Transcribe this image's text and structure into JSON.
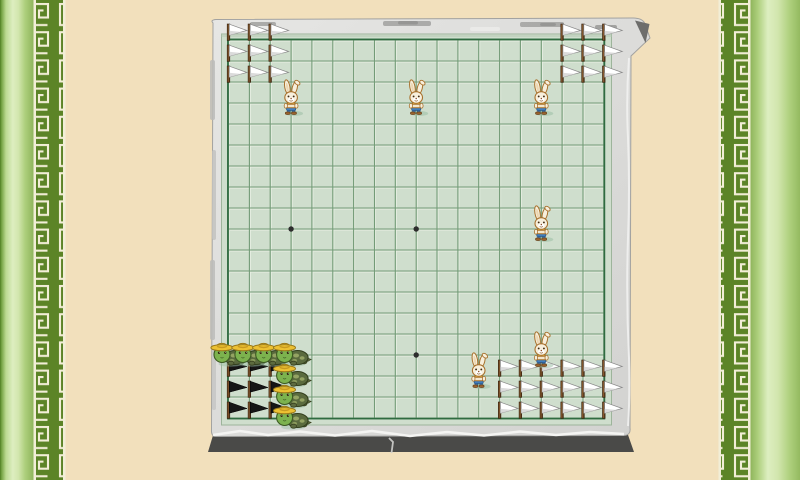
{
  "colors": {
    "background": "#f2e0bc",
    "side_gradient": [
      "#4e7d22",
      "#77a546",
      "#bcda92",
      "#ddeec0",
      "#d2e6ae",
      "#adcf7c",
      "#8fb55c"
    ],
    "meander_background": "#5c8427",
    "meander_pattern": "#f2eed7",
    "frame_light": "#dcdcda",
    "frame_mid": "#d2d2d0",
    "frame_dark_side": "#4a4a48",
    "board_background": "#cfdecd",
    "grid_line": "#6f9873",
    "grid_highlight": "#edf3e8",
    "grid_border": "#2f6b40",
    "star_point": "#2d2d2d",
    "white_flag": "#ffffff",
    "white_flag_shade": "#d5d5d5",
    "black_flag": "#161616",
    "flag_pole": "#5b3a1c",
    "flag_pole_dark": "#3a2410",
    "rabbit_body": "#f7efdc",
    "rabbit_outline": "#a8702c",
    "rabbit_pants": "#3f7dbd",
    "rabbit_shoes": "#9a6430",
    "turtle_skin": "#7cb24e",
    "turtle_skin_outline": "#3c5a22",
    "turtle_shell": "#5a6a3e",
    "turtle_shell_spot": "#94a363",
    "turtle_hat": "#ecc133",
    "turtle_hat_crown": "#f2ce49",
    "shadow": "#9dbfa6"
  },
  "board": {
    "type": "go-board",
    "lines": 19,
    "origin": [
      228.5,
      40
    ],
    "step": [
      20.85,
      21.0
    ],
    "star_points": [
      [
        3,
        3
      ],
      [
        9,
        3
      ],
      [
        15,
        3
      ],
      [
        3,
        9
      ],
      [
        9,
        9
      ],
      [
        15,
        9
      ],
      [
        3,
        15
      ],
      [
        9,
        15
      ],
      [
        15,
        15
      ]
    ]
  },
  "pieces": {
    "rabbits": {
      "name": "rabbit",
      "positions": [
        [
          3,
          3
        ],
        [
          9,
          3
        ],
        [
          15,
          3
        ],
        [
          15,
          9
        ],
        [
          15,
          15
        ],
        [
          12,
          16
        ]
      ]
    },
    "turtles": {
      "name": "turtle",
      "positions": [
        [
          0,
          15
        ],
        [
          1,
          15
        ],
        [
          2,
          15
        ],
        [
          3,
          15
        ],
        [
          3,
          16
        ],
        [
          3,
          17
        ],
        [
          3,
          18
        ]
      ]
    },
    "white_flags": {
      "name": "white-territory-flag",
      "positions": [
        [
          0,
          0
        ],
        [
          1,
          0
        ],
        [
          2,
          0
        ],
        [
          0,
          1
        ],
        [
          1,
          1
        ],
        [
          2,
          1
        ],
        [
          0,
          2
        ],
        [
          1,
          2
        ],
        [
          2,
          2
        ],
        [
          16,
          0
        ],
        [
          17,
          0
        ],
        [
          18,
          0
        ],
        [
          16,
          1
        ],
        [
          17,
          1
        ],
        [
          18,
          1
        ],
        [
          16,
          2
        ],
        [
          17,
          2
        ],
        [
          18,
          2
        ],
        [
          13,
          16
        ],
        [
          14,
          16
        ],
        [
          15,
          16
        ],
        [
          16,
          16
        ],
        [
          17,
          16
        ],
        [
          18,
          16
        ],
        [
          13,
          17
        ],
        [
          14,
          17
        ],
        [
          15,
          17
        ],
        [
          16,
          17
        ],
        [
          17,
          17
        ],
        [
          18,
          17
        ],
        [
          13,
          18
        ],
        [
          14,
          18
        ],
        [
          15,
          18
        ],
        [
          16,
          18
        ],
        [
          17,
          18
        ],
        [
          18,
          18
        ]
      ]
    },
    "black_flags": {
      "name": "black-territory-flag",
      "positions": [
        [
          0,
          16
        ],
        [
          1,
          16
        ],
        [
          2,
          16
        ],
        [
          0,
          17
        ],
        [
          1,
          17
        ],
        [
          2,
          17
        ],
        [
          0,
          18
        ],
        [
          1,
          18
        ],
        [
          2,
          18
        ]
      ]
    }
  }
}
